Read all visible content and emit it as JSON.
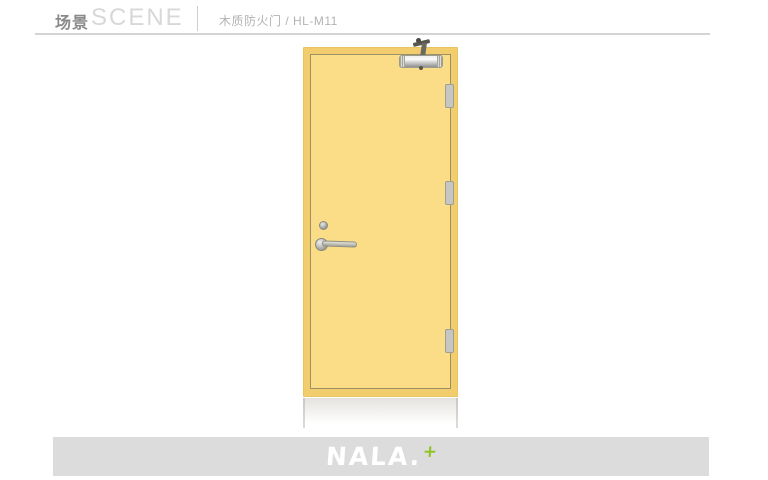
{
  "header": {
    "title_cn": "场景",
    "title_en": "SCENE",
    "product_label": "木质防火门 / HL-M11"
  },
  "footer": {
    "logo_text": "NALA.",
    "logo_mark": "+"
  },
  "colors": {
    "door_panel": "#fbdd88",
    "door_edge": "#f2cd6e",
    "panel_line": "#9a9166",
    "hardware_silver": "#c6c6c2",
    "accent_green": "#8dc220",
    "footer_bar": "#dcdcdc",
    "header_text": "#8a8a8a",
    "header_watermark": "#d8d8d8",
    "product_text": "#b3b3b3"
  }
}
